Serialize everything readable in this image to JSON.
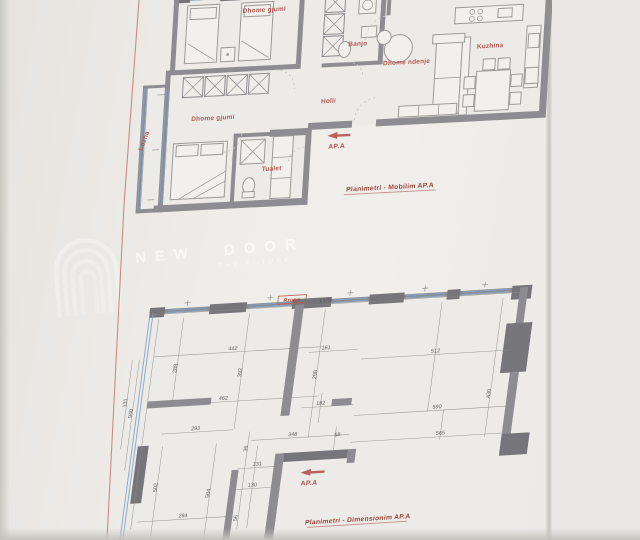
{
  "photo": {
    "background": "#efede9",
    "paper_edge_band": "#e9e8e6"
  },
  "colors": {
    "wall": "#8d8d91",
    "wall_dark": "#75757a",
    "window_blue": "#84a3c6",
    "label_red": "#b5504b",
    "caption_red": "#a1463f",
    "dimension_text": "#4f4f56",
    "boundary_red": "#c4736d"
  },
  "watermark": {
    "brand": "NEW DOOR",
    "tagline": "THE FUTURE",
    "logo": "door-arch-logo"
  },
  "plans": [
    {
      "name": "mobilim",
      "caption": "Planimetri - Mobilim AP.A",
      "entrance": "AP.A",
      "labels": [
        {
          "text": "Dhome gjumi",
          "x": 135,
          "y": 22,
          "r": 0
        },
        {
          "text": "Banjo",
          "x": 231,
          "y": 61,
          "r": 0
        },
        {
          "text": "Dhome ndenje",
          "x": 281,
          "y": 82,
          "r": 0
        },
        {
          "text": "Kuzhina",
          "x": 364,
          "y": 70,
          "r": 0
        },
        {
          "text": "Holli",
          "x": 205,
          "y": 117,
          "r": 0
        },
        {
          "text": "Dhome gjumi",
          "x": 90,
          "y": 128,
          "r": 0
        },
        {
          "text": "Tualet",
          "x": 152,
          "y": 182,
          "r": 0
        },
        {
          "text": "Lozha",
          "x": 24,
          "y": 146,
          "r": -72
        }
      ]
    },
    {
      "name": "dimensionim",
      "caption": "Planimetri - Dimensionim AP.A",
      "entrance": "AP.A",
      "facade_label": "Rruga",
      "dimensions": [
        {
          "v": "1379",
          "x": 206,
          "y": 13,
          "r": 0
        },
        {
          "v": "442",
          "x": 119,
          "y": 56,
          "r": 0
        },
        {
          "v": "161",
          "x": 213,
          "y": 61,
          "r": 0
        },
        {
          "v": "512",
          "x": 324,
          "y": 71,
          "r": 0
        },
        {
          "v": "288",
          "x": 65,
          "y": 71,
          "r": 90
        },
        {
          "v": "392",
          "x": 131,
          "y": 79,
          "r": 90
        },
        {
          "v": "298",
          "x": 207,
          "y": 86,
          "r": 90
        },
        {
          "v": "430",
          "x": 385,
          "y": 116,
          "r": 90
        },
        {
          "v": "462",
          "x": 116,
          "y": 106,
          "r": 0
        },
        {
          "v": "182",
          "x": 215,
          "y": 117,
          "r": 0
        },
        {
          "v": "590",
          "x": 333,
          "y": 128,
          "r": 0
        },
        {
          "v": "131",
          "x": 19,
          "y": 103,
          "r": 90
        },
        {
          "v": "940",
          "x": 26,
          "y": 114,
          "r": 90
        },
        {
          "v": "293",
          "x": 92,
          "y": 135,
          "r": 0
        },
        {
          "v": "348",
          "x": 191,
          "y": 147,
          "r": 0
        },
        {
          "v": "68",
          "x": 236,
          "y": 150,
          "r": 0
        },
        {
          "v": "565",
          "x": 340,
          "y": 155,
          "r": 0
        },
        {
          "v": "131",
          "x": 159,
          "y": 175,
          "r": 0
        },
        {
          "v": "130",
          "x": 157,
          "y": 196,
          "r": 0
        },
        {
          "v": "284",
          "x": 91,
          "y": 223,
          "r": 0
        },
        {
          "v": "504",
          "x": 115,
          "y": 200,
          "r": 90
        },
        {
          "v": "502",
          "x": 61,
          "y": 191,
          "r": 90
        },
        {
          "v": "36",
          "x": 147,
          "y": 157,
          "r": 90
        },
        {
          "v": "56",
          "x": 146,
          "y": 227,
          "r": 90
        }
      ]
    }
  ]
}
